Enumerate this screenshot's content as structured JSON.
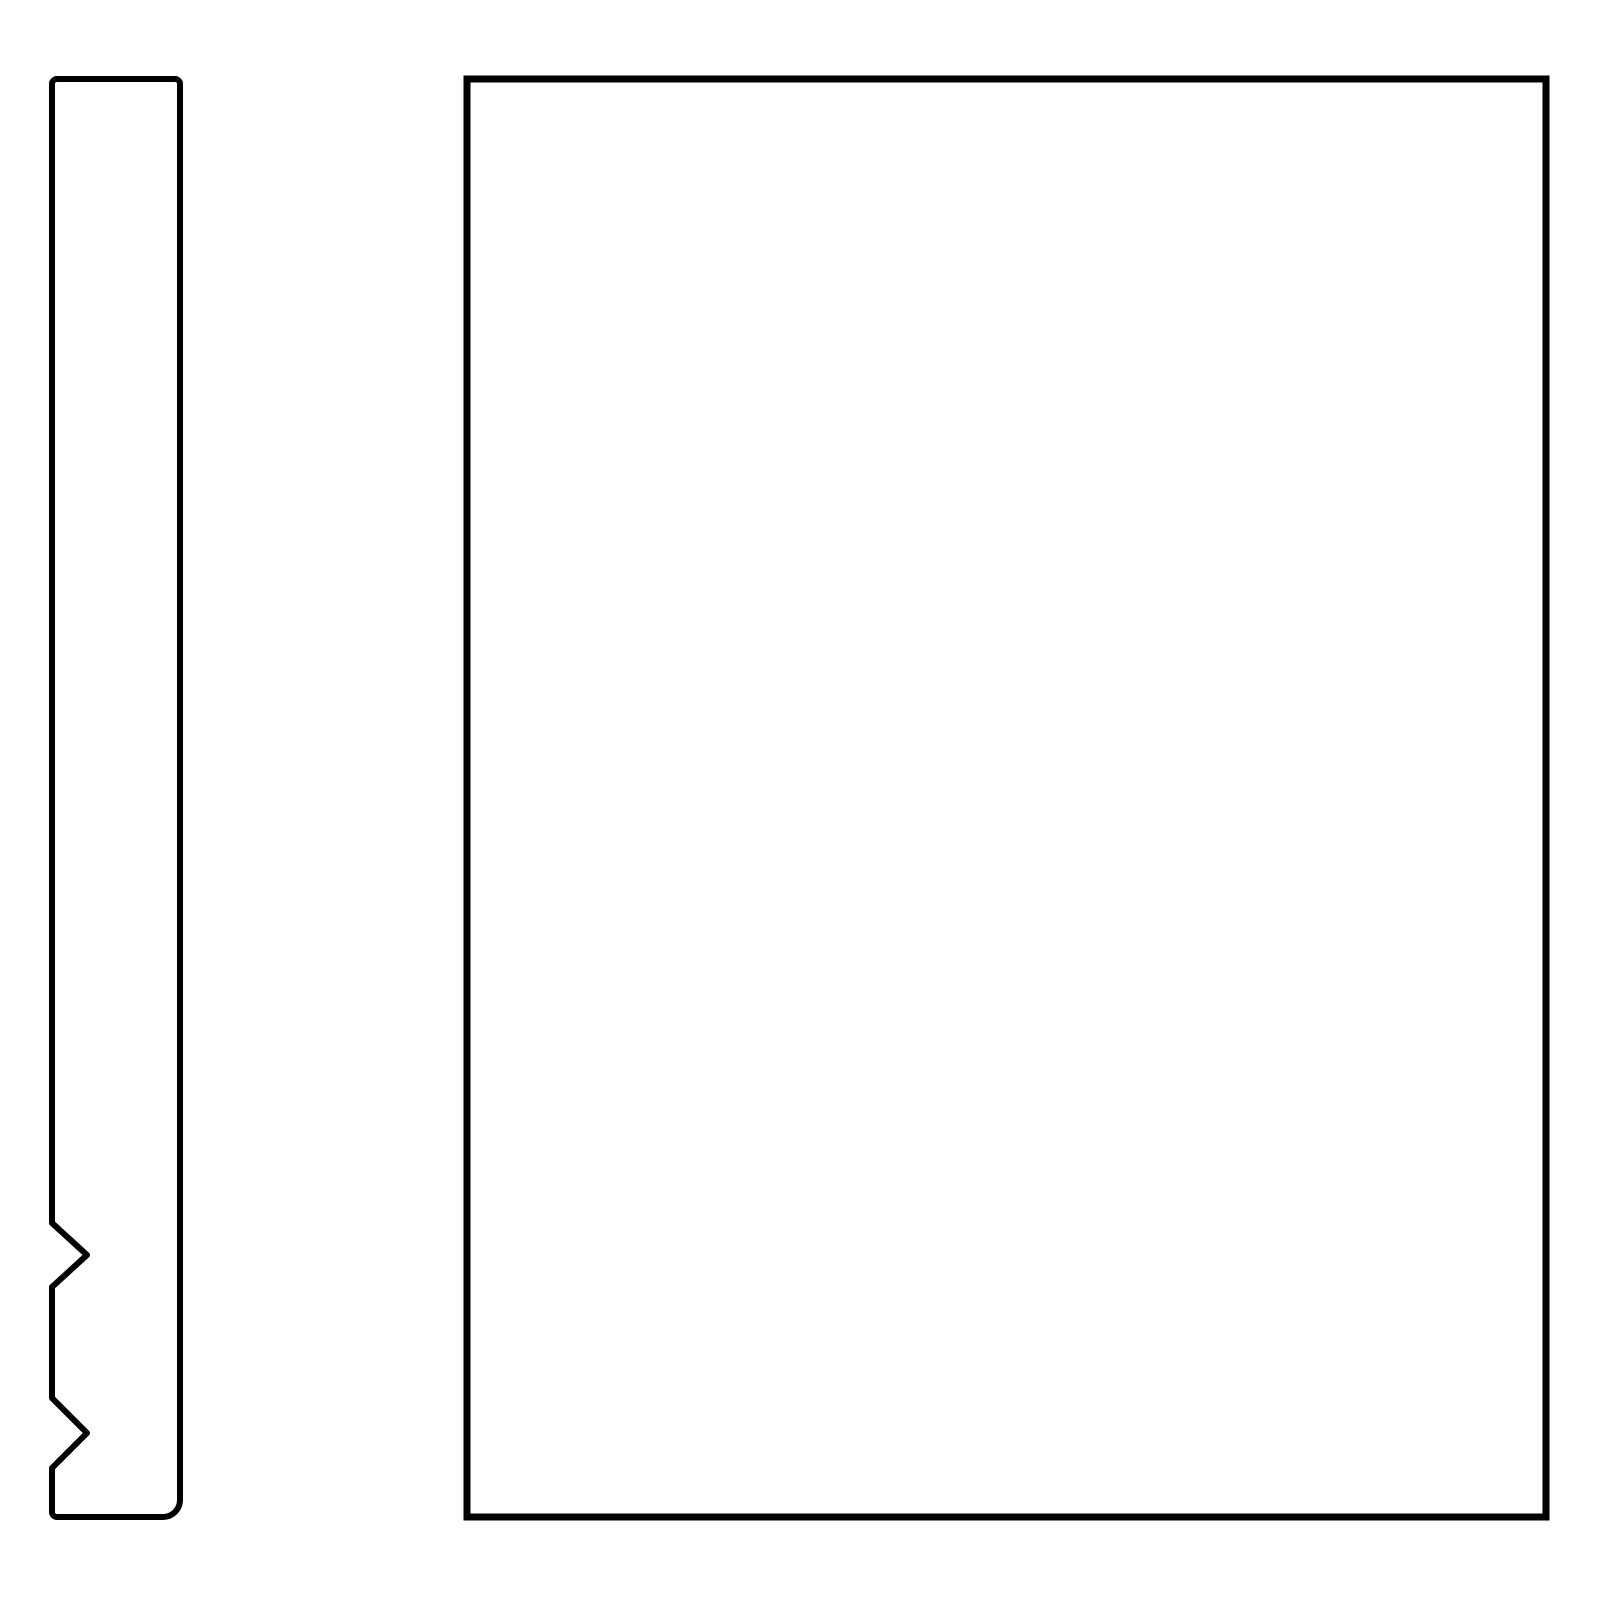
{
  "canvas": {
    "background_color": "#ffffff",
    "line_color": "#000000"
  },
  "shapes": {
    "profile_bar": {
      "name": "narrow-vertical-bar-with-two-break-notches",
      "notch_count": 2,
      "corner_style": "rounded-bottom-right"
    },
    "panel": {
      "name": "large-blank-rectangle",
      "corner_style": "square"
    }
  }
}
